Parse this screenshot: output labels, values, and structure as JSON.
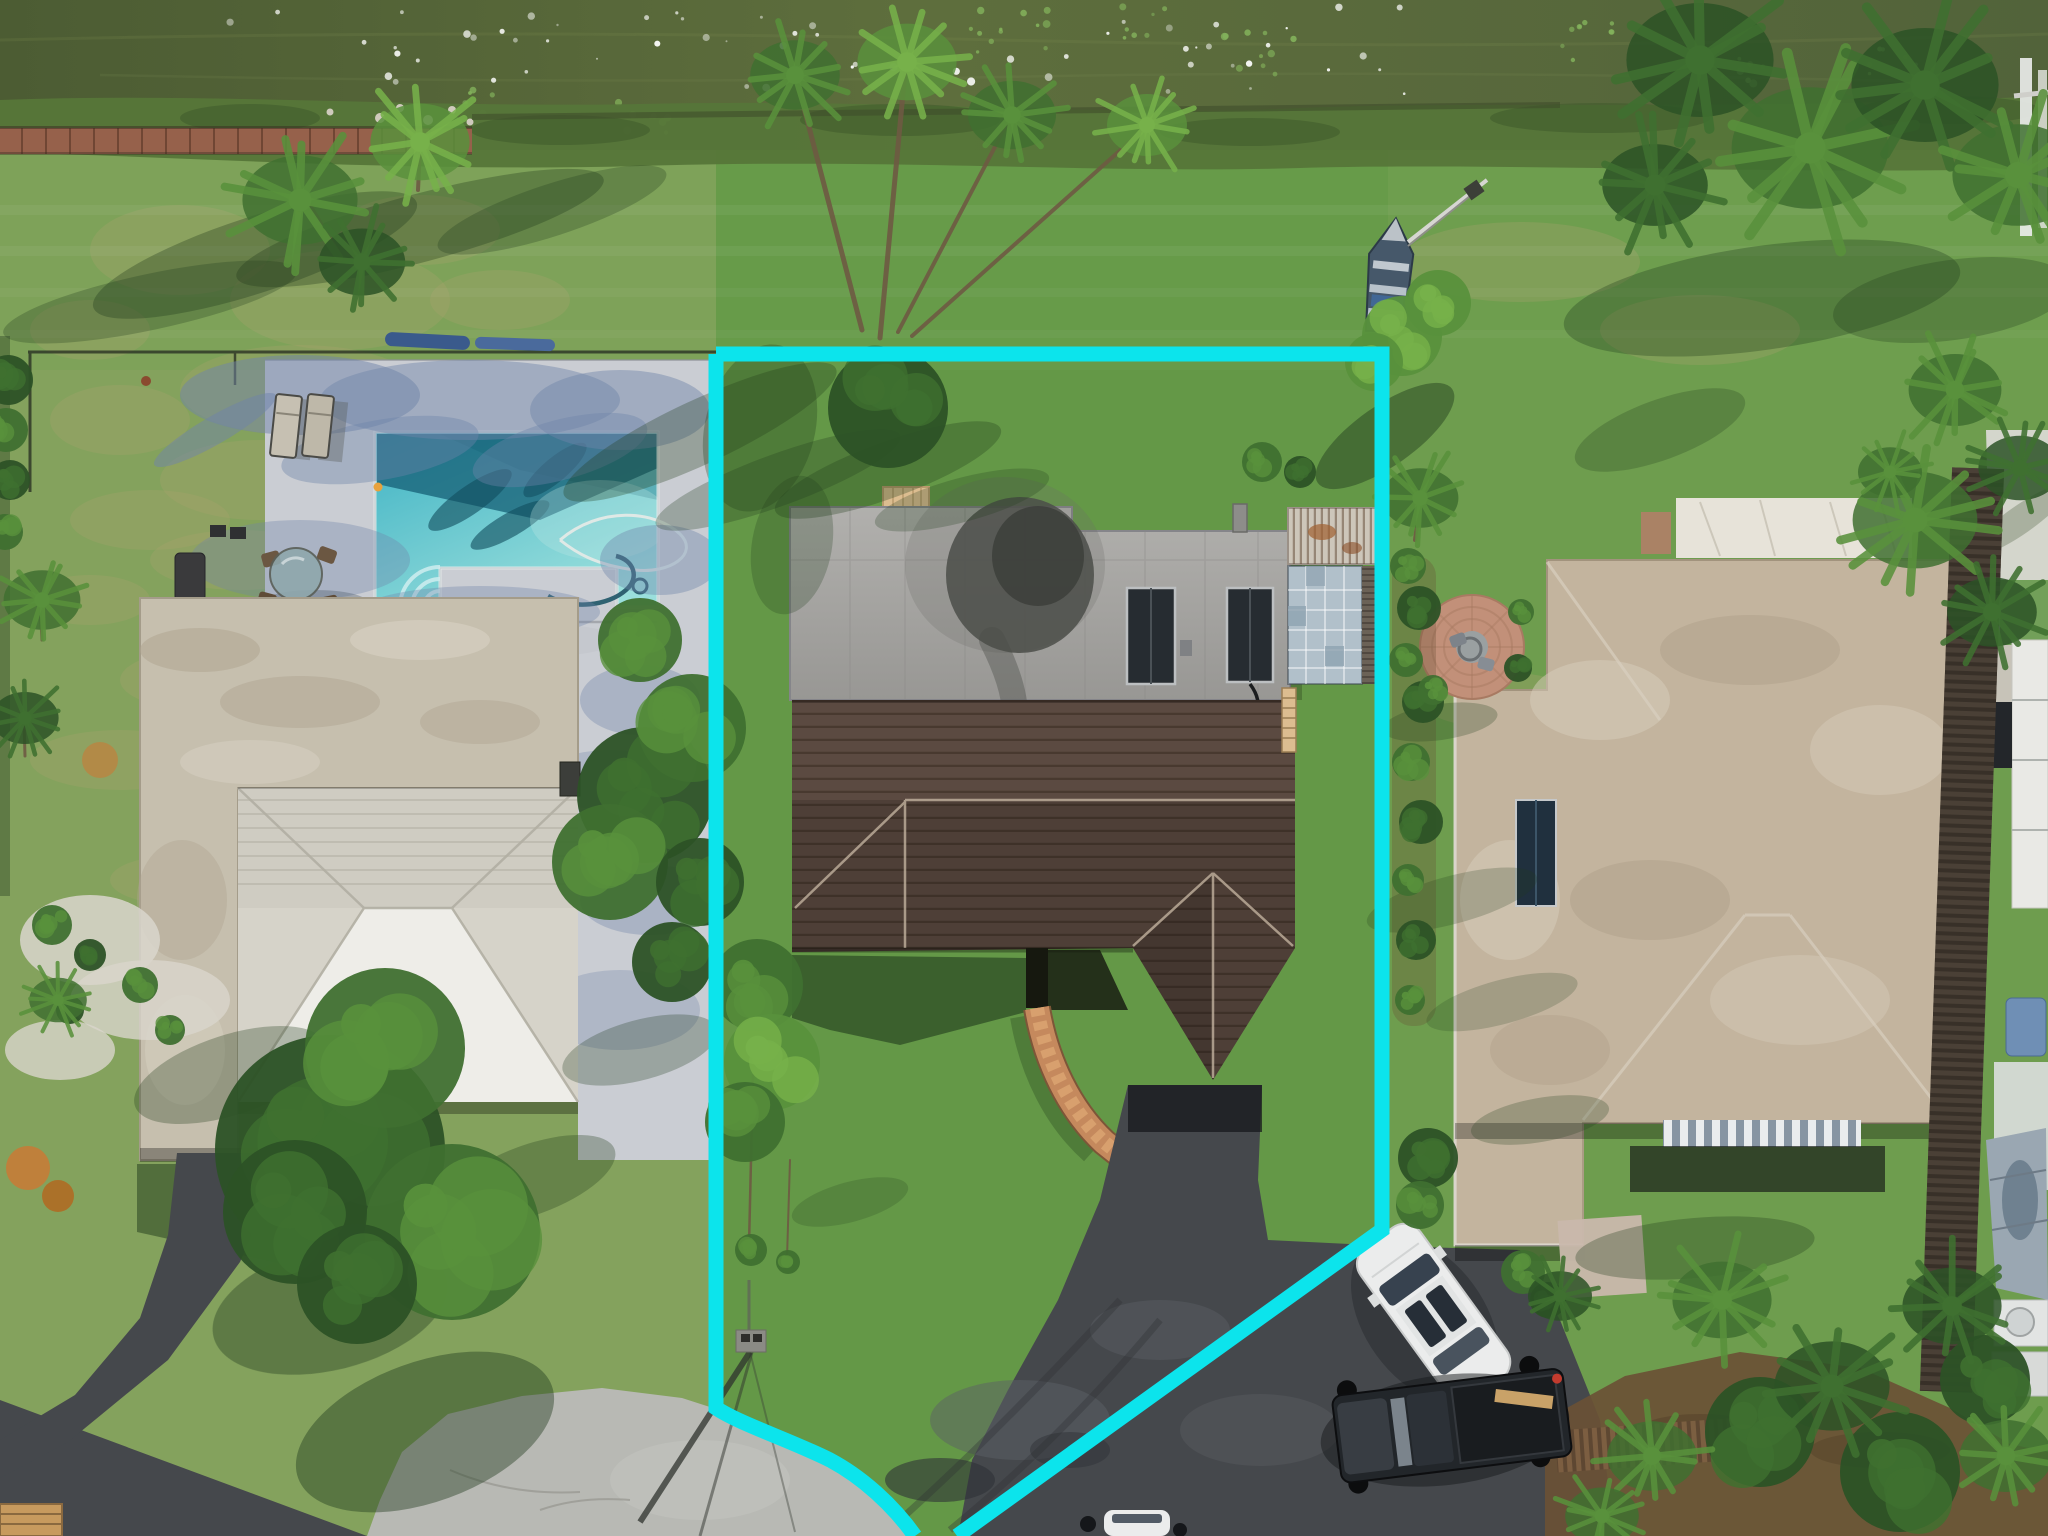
{
  "canvas": {
    "width": 2048,
    "height": 1536
  },
  "meta": {
    "type": "aerial-drone-photograph",
    "subject": "waterfront single-family home lot outlined with a cyan property-boundary overlay",
    "visible_text": "none"
  },
  "overlay": {
    "name": "property-boundary",
    "color": "#0ce4ec",
    "stroke_px": 15,
    "right_side_path": "M716,354 H1382 V1230 L957,1536",
    "left_side_path": "M716,354 V1408 C740,1424 790,1440 830,1460 C862,1477 893,1505 915,1536"
  },
  "scene": {
    "waterfront": {
      "water": "dark olive-green lake with sun sparkles and lily pads",
      "shoreline": "reedy vegetation strip",
      "boardwalk": "red-brown plank seawall walk on the left half",
      "jon_boat": "small blue-grey boat with white bench seats pulled onto the lawn",
      "boat_pole": "long light pole leaning from the boat toward shore"
    },
    "left_property": {
      "pool": "rectangular turquoise pool with corner steps, float and cleaning hoses",
      "pool_deck": "pale concrete deck shaded by palms",
      "furniture": [
        "2 chaise lounges",
        "round glass patio table with 4 chairs",
        "bbq grill",
        "2 umbrella bases",
        "2 blue kayaks on lawn"
      ],
      "house": "flat beige roof with bright white hip-roof section and carport wing",
      "yard": "patchy dry grass, black dog fence, white gravel planting beds",
      "driveway": "dark asphalt curving to the street"
    },
    "subject_property": {
      "highlighted": true,
      "house": {
        "rear_roof": "weathered flat grey roof with large dark stain",
        "solar_panels": 2,
        "front_roof": "dark brown shingle hip roof with two gables",
        "entry": "recessed dark entry with curved red-brick walkway"
      },
      "backyard_items": [
        "tan equipment mat",
        "white lounge chair",
        "roof vent",
        "pergola with weathered slats",
        "glass-block patio",
        "wooden ladder"
      ],
      "driveway": "wide asphalt drive curving to a concrete cul-de-sac",
      "utility_pole": "pole with long shadow near the street corner"
    },
    "right_property": {
      "house": "large tan hip roof, white roof section, one solar panel, striped carport awning",
      "yard": [
        "circular brick paver patio with fire pit and two chairs",
        "hedge row along the lot line",
        "mulch beds with palms",
        "wood fences"
      ],
      "far_right": [
        "white neighbor walkway",
        "tall dark wood fence",
        "tarp-covered boat",
        "ac equipment",
        "boat lift over water"
      ]
    },
    "street": {
      "cul_de_sac": "light concrete bulb",
      "road": "asphalt leaving bottom-left",
      "bench": "wooden bench at bottom-left corner"
    },
    "vehicles": [
      {
        "name": "white-suv",
        "desc": "white SUV with dark sunroof parked diagonally on the drive"
      },
      {
        "name": "pickup-truck",
        "desc": "dark pickup truck with tan plank in bed, red taillight"
      },
      {
        "name": "partial-vehicle",
        "desc": "white vehicle entering frame at bottom edge"
      },
      {
        "name": "white-car-under-trees",
        "desc": "white car mostly hidden by tree canopy on left lot"
      }
    ]
  },
  "colors": {
    "water-1": "#4c5c33",
    "water-2": "#5e6e3d",
    "shore": "#567639",
    "shore-dark": "#415c2d",
    "boardwalk": "#96614b",
    "seawall": "#3f4d2c",
    "grass-base": "#74a050",
    "grass-left": "#94a469",
    "grass-center": "#58923f",
    "grass-right": "#679a4c",
    "grass-back": "#70a150",
    "dry-grass": "#a7a26e",
    "deck": "#cacdd3",
    "deck-shadow": "#6f84a9",
    "pool-main": "#3fb3c4",
    "pool-light": "#9adfdc",
    "pool-edge": "#207d92",
    "pool-dark": "#155f75",
    "roof-beige": "#c6bfae",
    "roof-beige-dark": "#b0a592",
    "roof-beige-light": "#d8d2c3",
    "hip-white": "#eeede8",
    "hip-gray": "#d6d3c9",
    "ridge-line": "#b2afa3",
    "gray-roof-1": "#b1b0ad",
    "gray-roof-2": "#989794",
    "roof-stain": "#4b4d49",
    "roof-seam": "#8b8a88",
    "solar": "#262c31",
    "solar-frame": "#bcbfc1",
    "brown-roof": "#5b4a41",
    "brown-roof-dark": "#372c25",
    "ridge-cap": "#c9b9a5",
    "brick": "#c5895d",
    "brick-light": "#daa471",
    "brick-dark": "#7d5638",
    "asphalt": "#45484c",
    "asphalt-dark": "#2f3237",
    "asphalt-light": "#5c6065",
    "concrete": "#b8b9b4",
    "concrete-dark": "#8f9089",
    "right-roof": "#c3b49e",
    "right-roof-light": "#d7cdbb",
    "right-roof-dark": "#ab9c85",
    "white-roof": "#e7e3d9",
    "tree-dark": "#2c5226",
    "tree-mid": "#3f7030",
    "tree-light": "#59913c",
    "palm-light": "#77b14a",
    "shadow-green": "#203a1c",
    "mulch": "#6a5135",
    "wood-fence": "#7d5f42",
    "wood-fence-dark": "#5e4732",
    "car-white": "#ebecec",
    "glass": "#37424f",
    "truck-body": "#22262a",
    "truck-tan": "#c9a268",
    "brake-red": "#c23b2e",
    "boat-hull": "#46586a",
    "boat-light": "#cdd5da",
    "pergola": "#cdc6ba",
    "glass-block": "#b1c0ca",
    "pave": "#d9d9d3",
    "trunk": "#6e5a43",
    "gravel": "#d9d6cc",
    "fire-brick": "#c29079",
    "fire-center": "#9aa0a1",
    "orange-plant": "#c97a35",
    "mat-tan": "#dcbd90",
    "pole-gray": "#8b8b85",
    "bench-wood": "#c79a5e",
    "rock": "#cfcabc",
    "lilypad": "#84b45c",
    "boundary": "#0ce4ec",
    "sparkle": "#ffffff"
  },
  "effects": {
    "sparkles": {
      "region": [
        230,
        6,
        1180,
        88
      ],
      "count": 60
    },
    "lilypad_clusters": [
      [
        640,
        116,
        8,
        30
      ],
      [
        1000,
        36,
        12,
        48
      ],
      [
        1262,
        56,
        10,
        40
      ],
      [
        1582,
        42,
        9,
        35
      ],
      [
        1742,
        66,
        8,
        30
      ],
      [
        482,
        102,
        6,
        25
      ],
      [
        1892,
        62,
        6,
        25
      ],
      [
        1150,
        20,
        7,
        30
      ]
    ]
  },
  "vegetation": {
    "dry_patches": [
      [
        180,
        250,
        90,
        45
      ],
      [
        340,
        300,
        110,
        50
      ],
      [
        120,
        420,
        70,
        35
      ],
      [
        260,
        480,
        100,
        40
      ],
      [
        420,
        230,
        80,
        35
      ],
      [
        500,
        300,
        70,
        30
      ],
      [
        90,
        330,
        60,
        30
      ],
      [
        300,
        390,
        120,
        45
      ],
      [
        520,
        430,
        60,
        25
      ],
      [
        150,
        520,
        80,
        30
      ],
      [
        560,
        520,
        70,
        28
      ],
      [
        240,
        560,
        90,
        30
      ],
      [
        420,
        520,
        80,
        28
      ],
      [
        330,
        620,
        100,
        35
      ],
      [
        200,
        680,
        80,
        30
      ],
      [
        480,
        660,
        70,
        25
      ],
      [
        120,
        760,
        90,
        30
      ],
      [
        300,
        780,
        110,
        35
      ],
      [
        430,
        840,
        90,
        30
      ],
      [
        180,
        880,
        70,
        25
      ],
      [
        520,
        900,
        80,
        28
      ],
      [
        350,
        950,
        100,
        32
      ],
      [
        250,
        1020,
        80,
        28
      ],
      [
        90,
        600,
        60,
        25
      ],
      [
        1520,
        262,
        120,
        40
      ],
      [
        1700,
        330,
        100,
        35
      ],
      [
        1600,
        800,
        90,
        30
      ],
      [
        1500,
        700,
        80,
        28
      ]
    ],
    "ground_shadows": [
      [
        255,
        255,
        170,
        38,
        -18,
        0.33
      ],
      [
        420,
        228,
        190,
        34,
        -15,
        0.33
      ],
      [
        150,
        302,
        150,
        28,
        -12,
        0.28
      ],
      [
        552,
        210,
        120,
        26,
        -18,
        0.28
      ],
      [
        700,
        432,
        150,
        32,
        -25,
        0.3
      ],
      [
        778,
        480,
        130,
        26,
        -20,
        0.28
      ],
      [
        760,
        428,
        55,
        85,
        14,
        0.3
      ],
      [
        792,
        545,
        40,
        70,
        10,
        0.25
      ],
      [
        888,
        470,
        120,
        28,
        -20,
        0.3
      ],
      [
        962,
        500,
        90,
        22,
        -15,
        0.25
      ],
      [
        1385,
        436,
        82,
        30,
        -35,
        0.45
      ],
      [
        1452,
        900,
        88,
        24,
        -15,
        0.22
      ],
      [
        1502,
        1002,
        78,
        22,
        -15,
        0.2
      ],
      [
        1762,
        298,
        200,
        52,
        -8,
        0.32
      ],
      [
        1952,
        300,
        120,
        40,
        -8,
        0.28
      ],
      [
        1660,
        430,
        90,
        30,
        -20,
        0.25
      ],
      [
        425,
        1432,
        135,
        70,
        -20,
        0.42
      ],
      [
        330,
        1308,
        120,
        62,
        -14,
        0.38
      ],
      [
        230,
        1075,
        100,
        40,
        -18,
        0.3
      ],
      [
        530,
        1180,
        90,
        35,
        -20,
        0.3
      ],
      [
        640,
        1050,
        80,
        30,
        -15,
        0.28
      ],
      [
        1440,
        722,
        58,
        18,
        -8,
        0.25
      ],
      [
        1695,
        1248,
        120,
        30,
        -5,
        0.3
      ],
      [
        850,
        1202,
        60,
        20,
        -15,
        0.2
      ],
      [
        1540,
        1120,
        70,
        22,
        -10,
        0.25
      ]
    ],
    "deck_shadows": [
      [
        300,
        395,
        120,
        40,
        0,
        0.5
      ],
      [
        470,
        400,
        150,
        40,
        0,
        0.45
      ],
      [
        620,
        410,
        90,
        40,
        0,
        0.45
      ],
      [
        380,
        450,
        100,
        30,
        -10,
        0.4
      ],
      [
        560,
        450,
        90,
        30,
        -15,
        0.4
      ],
      [
        300,
        560,
        110,
        40,
        0,
        0.35
      ],
      [
        480,
        612,
        120,
        26,
        0,
        0.35
      ],
      [
        660,
        560,
        60,
        35,
        0,
        0.4
      ],
      [
        640,
        700,
        60,
        35,
        0,
        0.35
      ],
      [
        610,
        780,
        70,
        30,
        0,
        0.3
      ],
      [
        650,
        900,
        70,
        35,
        0,
        0.35
      ],
      [
        620,
        1010,
        80,
        40,
        0,
        0.3
      ],
      [
        215,
        430,
        70,
        14,
        -30,
        0.5
      ],
      [
        430,
        640,
        60,
        16,
        -20,
        0.35
      ]
    ],
    "trees": [
      [
        330,
        1150,
        115,
        0
      ],
      [
        452,
        1232,
        88,
        1
      ],
      [
        385,
        1048,
        80,
        1
      ],
      [
        295,
        1212,
        72,
        0
      ],
      [
        357,
        1284,
        60,
        0
      ],
      [
        645,
        795,
        68,
        0
      ],
      [
        692,
        728,
        54,
        1
      ],
      [
        610,
        862,
        58,
        1
      ],
      [
        700,
        882,
        44,
        0
      ],
      [
        672,
        962,
        40,
        0
      ],
      [
        640,
        640,
        42,
        1
      ],
      [
        757,
        985,
        46,
        1
      ],
      [
        772,
        1062,
        48,
        2
      ],
      [
        745,
        1122,
        40,
        1
      ],
      [
        751,
        1250,
        16,
        1
      ],
      [
        788,
        1262,
        12,
        1
      ],
      [
        888,
        408,
        60,
        0
      ],
      [
        1408,
        566,
        18,
        1
      ],
      [
        1419,
        608,
        22,
        0
      ],
      [
        1406,
        660,
        17,
        1
      ],
      [
        1423,
        702,
        21,
        0
      ],
      [
        1411,
        762,
        19,
        1
      ],
      [
        1421,
        822,
        22,
        0
      ],
      [
        1408,
        880,
        16,
        1
      ],
      [
        1416,
        940,
        20,
        0
      ],
      [
        1410,
        1000,
        15,
        1
      ],
      [
        1428,
        1158,
        30,
        0
      ],
      [
        1420,
        1205,
        24,
        1
      ],
      [
        1262,
        462,
        20,
        1
      ],
      [
        1300,
        472,
        16,
        0
      ],
      [
        1433,
        690,
        15,
        1
      ],
      [
        1518,
        668,
        14,
        0
      ],
      [
        1521,
        612,
        13,
        1
      ],
      [
        1523,
        1272,
        22,
        1
      ],
      [
        1548,
        1300,
        18,
        0
      ],
      [
        1402,
        336,
        40,
        2
      ],
      [
        1438,
        303,
        33,
        2
      ],
      [
        1374,
        362,
        29,
        2
      ],
      [
        1760,
        1432,
        55,
        0
      ],
      [
        1900,
        1472,
        60,
        0
      ],
      [
        1985,
        1380,
        45,
        0
      ],
      [
        8,
        380,
        25,
        0
      ],
      [
        6,
        430,
        22,
        1
      ],
      [
        10,
        480,
        20,
        0
      ],
      [
        5,
        532,
        18,
        1
      ],
      [
        52,
        925,
        20,
        1
      ],
      [
        90,
        955,
        16,
        0
      ],
      [
        140,
        985,
        18,
        1
      ],
      [
        70,
        1010,
        14,
        0
      ],
      [
        170,
        1030,
        15,
        1
      ]
    ],
    "palms": [
      [
        300,
        200,
        72,
        1
      ],
      [
        420,
        142,
        62,
        2
      ],
      [
        362,
        262,
        54,
        0
      ],
      [
        795,
        75,
        56,
        1
      ],
      [
        907,
        62,
        62,
        2
      ],
      [
        1012,
        115,
        55,
        1
      ],
      [
        1147,
        125,
        50,
        2
      ],
      [
        42,
        600,
        48,
        1
      ],
      [
        25,
        718,
        42,
        0
      ],
      [
        58,
        1000,
        36,
        1
      ],
      [
        1420,
        498,
        48,
        1
      ],
      [
        1700,
        60,
        92,
        0
      ],
      [
        1810,
        148,
        98,
        1
      ],
      [
        1925,
        85,
        92,
        0
      ],
      [
        2018,
        175,
        82,
        1
      ],
      [
        1655,
        185,
        66,
        0
      ],
      [
        1915,
        520,
        78,
        1
      ],
      [
        1992,
        612,
        56,
        0
      ],
      [
        1890,
        472,
        40,
        1
      ],
      [
        1955,
        390,
        58,
        1
      ],
      [
        2020,
        468,
        52,
        0
      ],
      [
        1722,
        1300,
        62,
        1
      ],
      [
        1832,
        1386,
        72,
        0
      ],
      [
        1652,
        1456,
        56,
        1
      ],
      [
        1952,
        1306,
        62,
        0
      ],
      [
        2006,
        1456,
        58,
        1
      ],
      [
        1602,
        1516,
        46,
        1
      ],
      [
        1560,
        1296,
        40,
        0
      ]
    ],
    "trunks": [
      [
        862,
        330,
        798,
        85,
        5
      ],
      [
        880,
        338,
        905,
        72,
        5
      ],
      [
        898,
        332,
        1008,
        122,
        4
      ],
      [
        912,
        336,
        1143,
        130,
        4
      ],
      [
        340,
        255,
        310,
        205,
        4
      ],
      [
        418,
        190,
        420,
        148,
        4
      ],
      [
        1415,
        540,
        1420,
        500,
        4
      ],
      [
        42,
        640,
        40,
        604,
        3
      ],
      [
        25,
        756,
        24,
        722,
        3
      ],
      [
        753,
        1075,
        749,
        1245,
        2.5
      ],
      [
        790,
        1160,
        787,
        1258,
        2
      ]
    ]
  }
}
